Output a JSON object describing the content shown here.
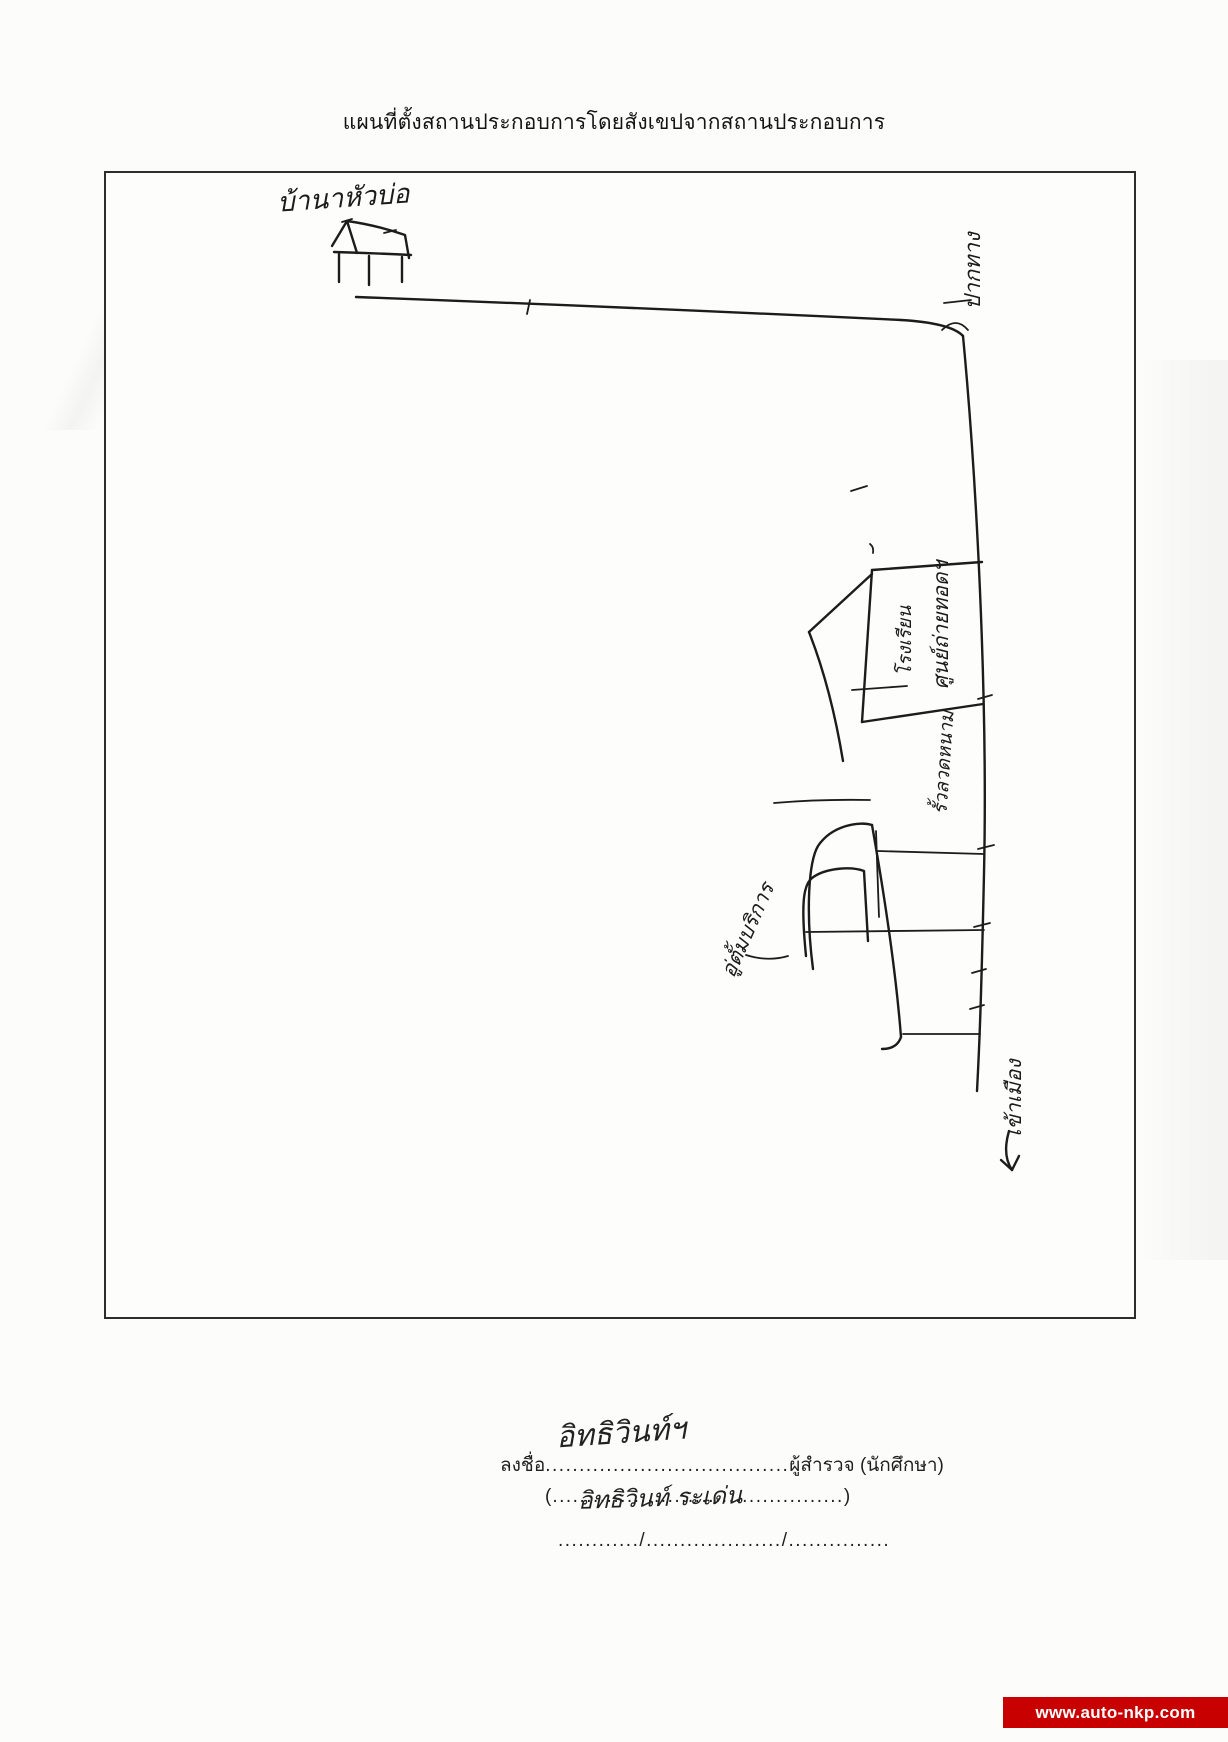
{
  "document": {
    "title": "แผนที่ตั้งสถานประกอบการโดยสังเขปจากสถานประกอบการ"
  },
  "map_labels": {
    "village_house": "บ้านาหัวบ่อ",
    "road_top": "ปากทาง",
    "building_label_main": "ศูนย์ถ่ายทอดฯ",
    "building_label_sub": "โรงเรียน",
    "roadside_label": "รั้วลวดหนาม",
    "garage_label": "อู่ตั้มบริการ",
    "to_town": "เข้าเมือง"
  },
  "signature_block": {
    "sign_prefix": "ลงชื่อ",
    "sign_dots": "....................................",
    "sign_suffix": "ผู้สำรวจ (นักศึกษา)",
    "handwritten_signature": "อิทธิวินท์ฯ",
    "paren_open": "(",
    "name_dots": "...........................................",
    "paren_close": ")",
    "handwritten_name": "อิทธิวินท์ ระเด่น",
    "date_line": "............/..................../..............."
  },
  "watermark": {
    "url_text": "www.auto-nkp.com"
  }
}
